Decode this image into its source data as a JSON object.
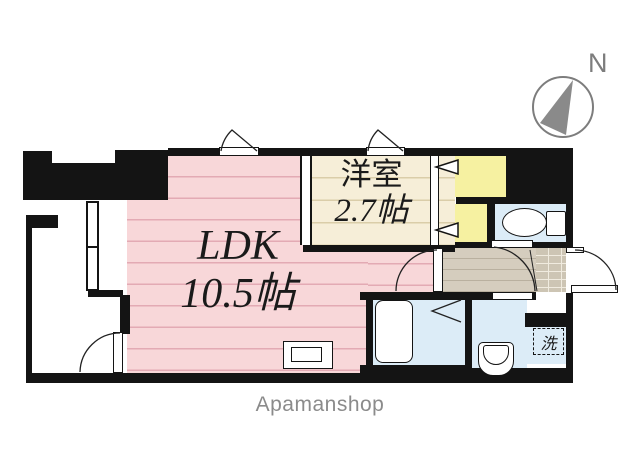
{
  "floorplan": {
    "compass": {
      "label": "N"
    },
    "rooms": {
      "ldk": {
        "name": "LDK",
        "size": "10.5帖"
      },
      "western_room": {
        "name": "洋室",
        "size": "2.7帖"
      },
      "laundry_label": "洗"
    },
    "watermark": "Apamanshop",
    "colors": {
      "wall": "#141414",
      "ldk_pink": "#f8d7d9",
      "ldk_stripe": "#e3aab4",
      "western_room_cream": "#f6eed8",
      "western_room_stripe": "#dacda9",
      "closet_yellow": "#f6f1a1",
      "wet_area_blue": "#dcecf7",
      "hallway_gray": "#d5cdbe",
      "entrance_tile": "#cdc5b4",
      "compass_gray": "#7d7d7d",
      "watermark_gray": "#8b8b8b"
    }
  }
}
